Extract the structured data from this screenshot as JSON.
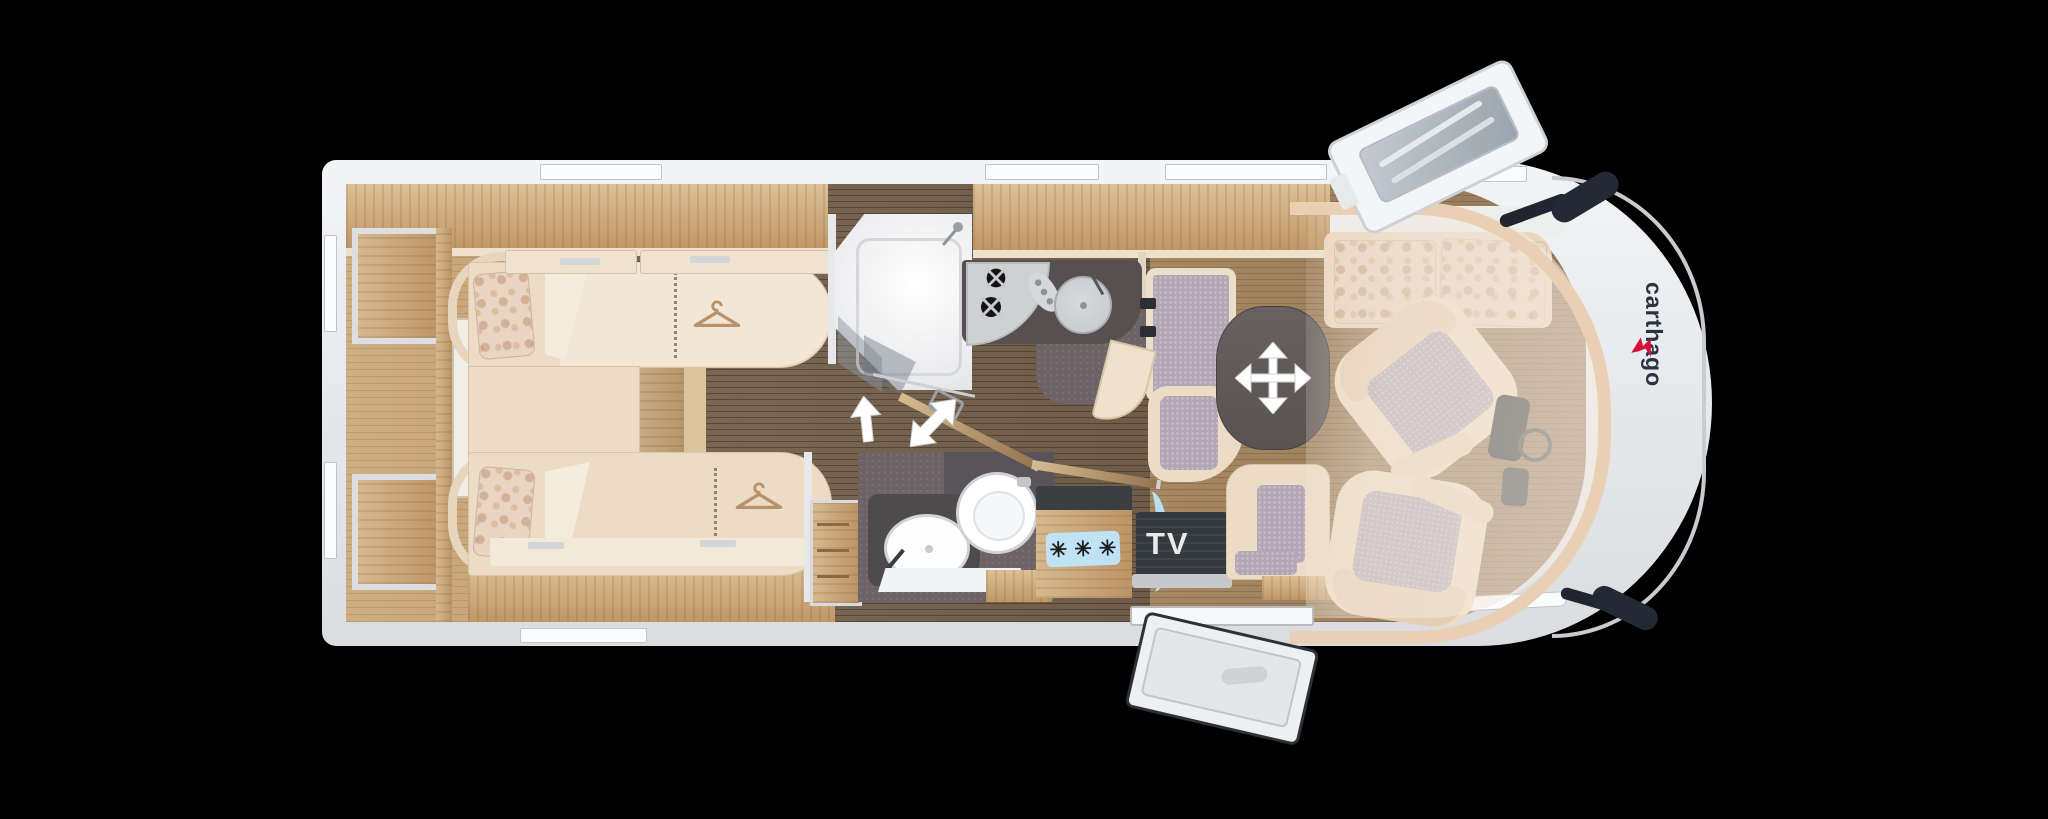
{
  "scene": {
    "background": "#000000"
  },
  "plan": {
    "labels": {
      "tv": "TV"
    },
    "fridge": {
      "snowflakes": "✳✳✳"
    },
    "logo": {
      "text": "carthago"
    },
    "icons": {
      "bed_hanger": "clothes-hanger",
      "table_adjust": "four-way-move-arrow",
      "partition_slide": "double-headed-arrow",
      "door_direction": "up-arrow",
      "fridge_rating": "three-snowflakes",
      "shower": "shower-head",
      "hob": "two-burner-hob",
      "sink": "round-sink",
      "toilet": "toilet",
      "washbasin": "oval-washbasin"
    },
    "colors": {
      "bg": "#000000",
      "shell": "#eef0f2",
      "wall": "#d6d7da",
      "window": "#fbfcfe",
      "wood_light": "#cfae83",
      "wood_dark": "#6e5c49",
      "wood_mid": "#94785a",
      "overhead_wood": "#c9a378",
      "bed": "#ecdcc5",
      "linen": "#f4ecdd",
      "floral": "#e9d5c2",
      "purple": "#b3a7b5",
      "carpet": "#6d6366",
      "counter": "#575050",
      "table": "#5f5958",
      "tv": "#34393d",
      "blue": "#bfe2f5",
      "trim": "#e9cfb4",
      "arrow": "#ffffff",
      "steel": "#c9cbce",
      "logo": "#2a3342",
      "logo_accent": "#d6103a"
    }
  }
}
